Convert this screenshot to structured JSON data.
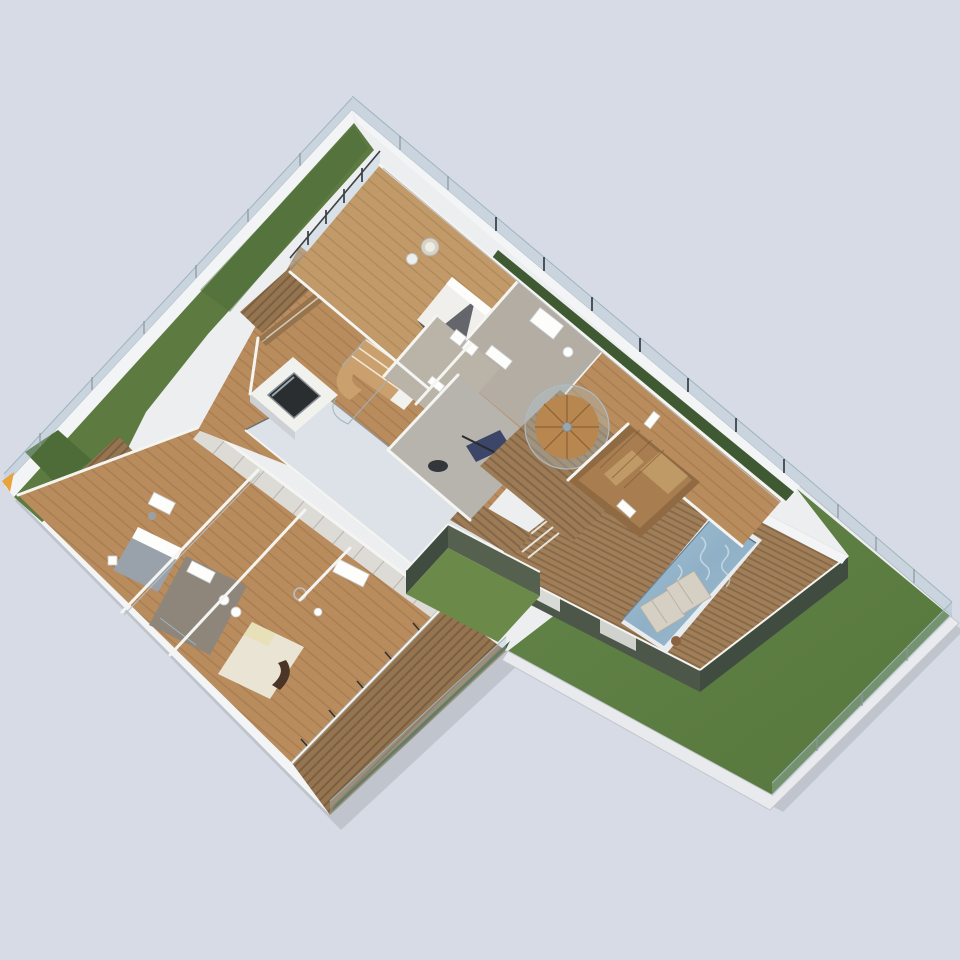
{
  "canvas": {
    "width": 960,
    "height": 960
  },
  "scene_type": "isometric-3d-floorplan-render",
  "palette": {
    "background": "#d6dbe5",
    "site_edge": "#eceef0",
    "parapet_white": "#f2f4f5",
    "grass_strip": "#5d7b41",
    "grass_dark": "#4e6c38",
    "lawn": "#5f8044",
    "courtyard_grass": "#6b8a49",
    "hedge": "#3f5a33",
    "path": "#e8eaed",
    "void_gray": "#dde2e8",
    "wall_white": "#f4f4f1",
    "wall_top_gray": "#cdd1d5",
    "olive_wall": "#4c574a",
    "olive_wall_dark": "#414c40",
    "deck_wood": "#9c7b55",
    "deck_wood_dark": "#84664a",
    "terrace_deck": "#a07e57",
    "interior_wood": "#b98c5e",
    "interior_wood_line": "#a87d50",
    "gym_floor": "#b6b4ad",
    "bath_floor": "#8e867b",
    "bath_floor_light": "#b3ada4",
    "pool_water": "#8fb0c6",
    "pool_water_light": "#a6c4d6",
    "pool_rim": "#e9ecee",
    "glass": "rgba(175,200,212,0.32)",
    "glass_frame": "#9fb4bd",
    "fence_post_dark": "#2e3236",
    "elevator_shaft": "#2a2e31",
    "bed_gray": "#99a1aa",
    "bed_cream": "#eae4d4",
    "pillow_yellow": "#e8e0b8",
    "throw_brown": "#4a3526",
    "bed_white": "#f0efec",
    "lounger_pale": "#d6cfc3",
    "sauna_wood": "#a87e50",
    "louver_wood": "#96744e",
    "stair_tread": "#c9a06e",
    "gym_equipment_navy": "#3c4668",
    "corner_marker_yellow": "#e8a33d"
  }
}
